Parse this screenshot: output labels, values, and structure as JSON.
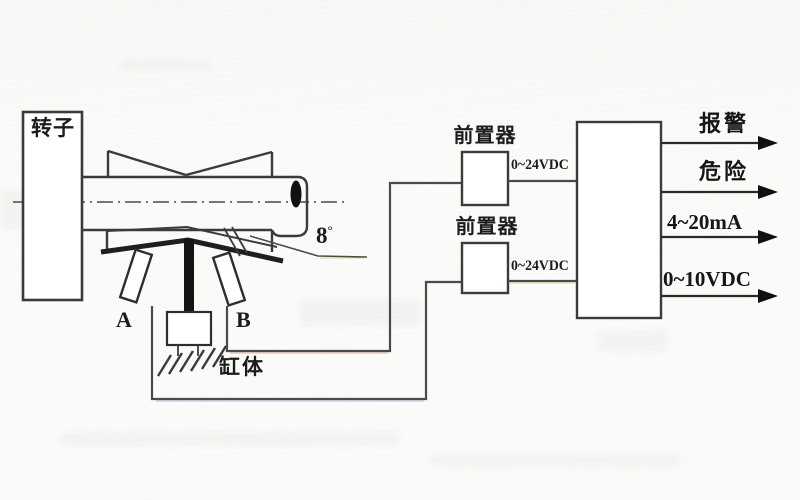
{
  "diagram": {
    "title_hint": "rotor axial displacement monitoring schematic",
    "rotor_label": "转子",
    "sensor_a_label": "A",
    "sensor_b_label": "B",
    "cylinder_label": "缸体",
    "angle_value": "8",
    "angle_degree": "°",
    "preamp1_label": "前置器",
    "preamp2_label": "前置器",
    "preamp1_supply": "0~24VDC",
    "preamp2_supply": "0~24VDC",
    "outputs": [
      {
        "label": "报警"
      },
      {
        "label": "危险"
      },
      {
        "label": "4~20mA"
      },
      {
        "label": "0~10VDC"
      }
    ],
    "colors": {
      "line": "#3b3b3b",
      "thick_line": "#1e1e1e",
      "fill_white": "#ffffff",
      "scan_fringe_yellow": "#cfc24d",
      "scan_fringe_red": "#c96a4f",
      "scan_fringe_blue": "#5f87b5"
    }
  }
}
